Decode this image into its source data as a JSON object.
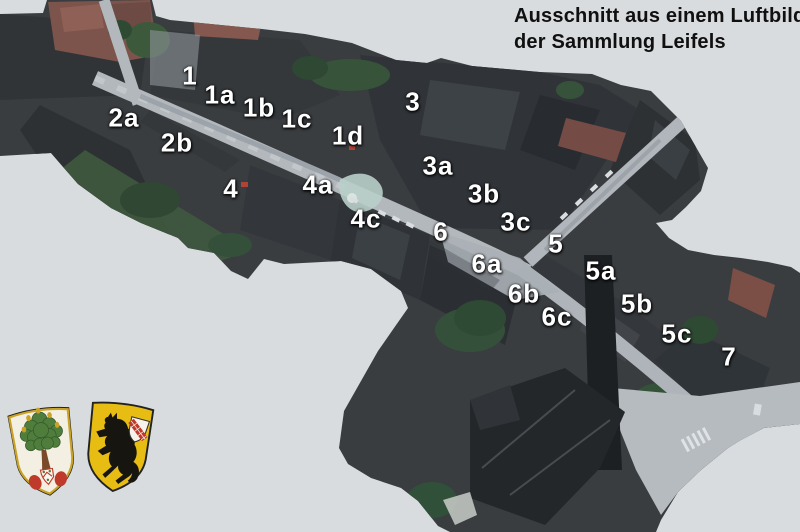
{
  "caption": {
    "line1": "Ausschnitt aus einem Luftbild",
    "line2": "der Sammlung Leifels"
  },
  "map_labels": [
    {
      "text": "1",
      "x": 190,
      "y": 76
    },
    {
      "text": "1a",
      "x": 220,
      "y": 95
    },
    {
      "text": "1b",
      "x": 259,
      "y": 108
    },
    {
      "text": "1c",
      "x": 297,
      "y": 119
    },
    {
      "text": "1d",
      "x": 348,
      "y": 136
    },
    {
      "text": "2a",
      "x": 124,
      "y": 118
    },
    {
      "text": "2b",
      "x": 177,
      "y": 143
    },
    {
      "text": "3",
      "x": 413,
      "y": 102
    },
    {
      "text": "3a",
      "x": 438,
      "y": 166
    },
    {
      "text": "3b",
      "x": 484,
      "y": 194
    },
    {
      "text": "3c",
      "x": 516,
      "y": 222
    },
    {
      "text": "4",
      "x": 231,
      "y": 189
    },
    {
      "text": "4a",
      "x": 318,
      "y": 185
    },
    {
      "text": "4c",
      "x": 366,
      "y": 219
    },
    {
      "text": "5",
      "x": 556,
      "y": 244
    },
    {
      "text": "5a",
      "x": 601,
      "y": 271
    },
    {
      "text": "5b",
      "x": 637,
      "y": 304
    },
    {
      "text": "5c",
      "x": 677,
      "y": 334
    },
    {
      "text": "6",
      "x": 441,
      "y": 232
    },
    {
      "text": "6a",
      "x": 487,
      "y": 264
    },
    {
      "text": "6b",
      "x": 524,
      "y": 294
    },
    {
      "text": "6c",
      "x": 557,
      "y": 317
    },
    {
      "text": "7",
      "x": 729,
      "y": 357
    }
  ],
  "emblems": [
    {
      "id": "oak-tree-coat-of-arms",
      "description": "white shield with green oak tree, red marks and small escutcheon"
    },
    {
      "id": "black-horse-coat-of-arms",
      "description": "gold shield with black rearing horse and small checkered-bend escutcheon"
    }
  ],
  "colors": {
    "background": "#d8dcde",
    "label_text": "#ffffff",
    "caption_text": "#101010",
    "shield_gold": "#e7bd13",
    "shield_green": "#4f7d3c",
    "shield_red": "#c03a2b"
  }
}
